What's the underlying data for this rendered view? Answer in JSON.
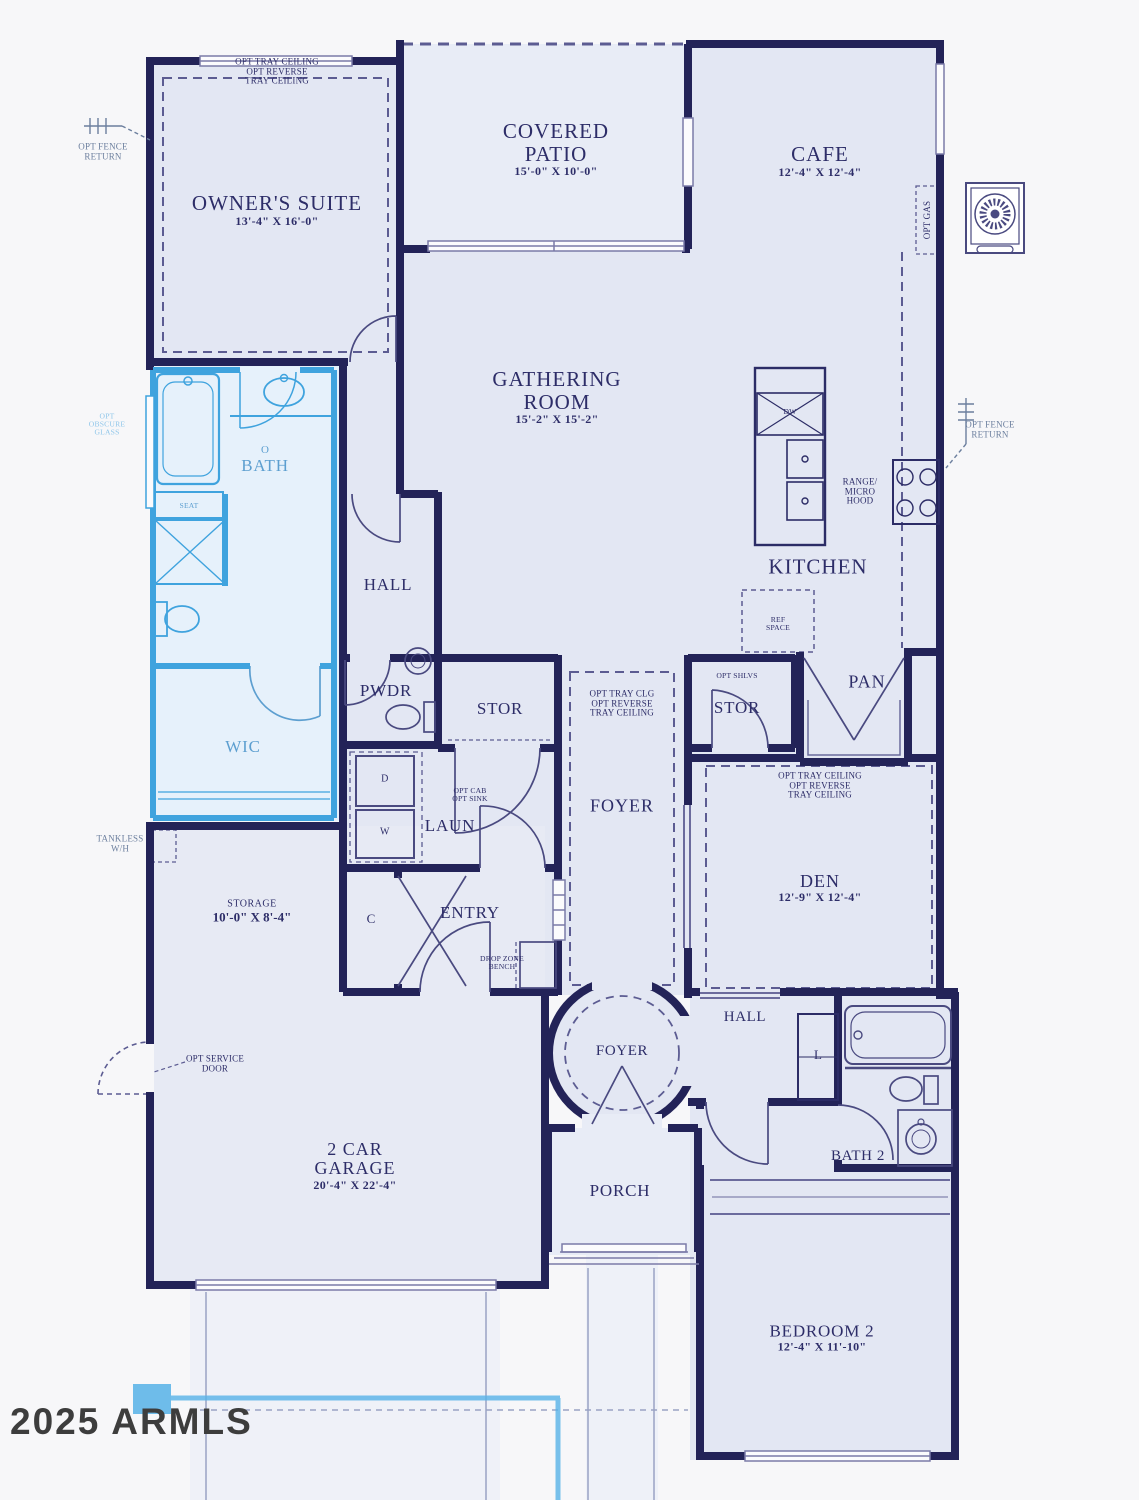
{
  "watermark": "2025 ARMLS",
  "colors": {
    "wall": "#232358",
    "room_fill": "#e3e7f3",
    "outdoor_fill": "#e8ecf6",
    "highlight": "#3fa3de",
    "highlight_fill": "#e6f1fb",
    "text": "#2d2d68",
    "watermark_text": "#3d3d3d"
  },
  "labels": {
    "owner_note": [
      "OPT TRAY CEILING",
      "OPT REVERSE",
      "TRAY CEILING"
    ],
    "owners_suite": {
      "name": "OWNER'S SUITE",
      "dims": "13'-4\" X 16'-0\""
    },
    "covered_patio": {
      "line1": "COVERED",
      "line2": "PATIO",
      "dims": "15'-0\" X 10'-0\""
    },
    "cafe": {
      "name": "CAFE",
      "dims": "12'-4\" X 12'-4\""
    },
    "fence_left": [
      "OPT FENCE",
      "RETURN"
    ],
    "fence_right": [
      "OPT FENCE",
      "RETURN"
    ],
    "opt_gas": "OPT GAS",
    "gathering": {
      "line1": "GATHERING",
      "line2": "ROOM",
      "dims": "15'-2\" X 15'-2\""
    },
    "kitchen": "KITCHEN",
    "range_note": [
      "RANGE/",
      "MICRO",
      "HOOD"
    ],
    "dw": "DW",
    "ref_note": [
      "REF",
      "SPACE"
    ],
    "pan": "PAN",
    "opt_shlvs": "OPT SHLVS",
    "stor_right": "STOR",
    "stor_left": "STOR",
    "pwdr": "PWDR",
    "hall_upper": "HALL",
    "obath": {
      "line1": "O",
      "line2": "BATH"
    },
    "seat": "SEAT",
    "obscure_note": [
      "OPT",
      "OBSCURE",
      "GLASS"
    ],
    "wic": "WIC",
    "tankless_note": [
      "TANKLESS",
      "W/H"
    ],
    "laun": "LAUN",
    "laun_note": [
      "OPT CAB",
      "OPT SINK"
    ],
    "dryer": "D",
    "washer": "W",
    "entry": "ENTRY",
    "closet_c": "C",
    "drop_note": [
      "DROP ZONE",
      "BENCH"
    ],
    "foyer_gallery": "FOYER",
    "foyer_note": [
      "OPT TRAY CLG",
      "OPT REVERSE",
      "TRAY CEILING"
    ],
    "den": {
      "name": "DEN",
      "dims": "12'-9\" X 12'-4\""
    },
    "den_note": [
      "OPT TRAY CEILING",
      "OPT REVERSE",
      "TRAY CEILING"
    ],
    "foyer_rotunda": "FOYER",
    "hall_lower": "HALL",
    "linen": "L",
    "bath2": "BATH 2",
    "storage": {
      "name": "STORAGE",
      "dims": "10'-0\" X 8'-4\""
    },
    "service_note": [
      "OPT SERVICE",
      "DOOR"
    ],
    "garage": {
      "line1": "2 CAR",
      "line2": "GARAGE",
      "dims": "20'-4\" X 22'-4\""
    },
    "porch": "PORCH",
    "bedroom2": {
      "name": "BEDROOM 2",
      "dims": "12'-4\" X 11'-10\""
    }
  }
}
